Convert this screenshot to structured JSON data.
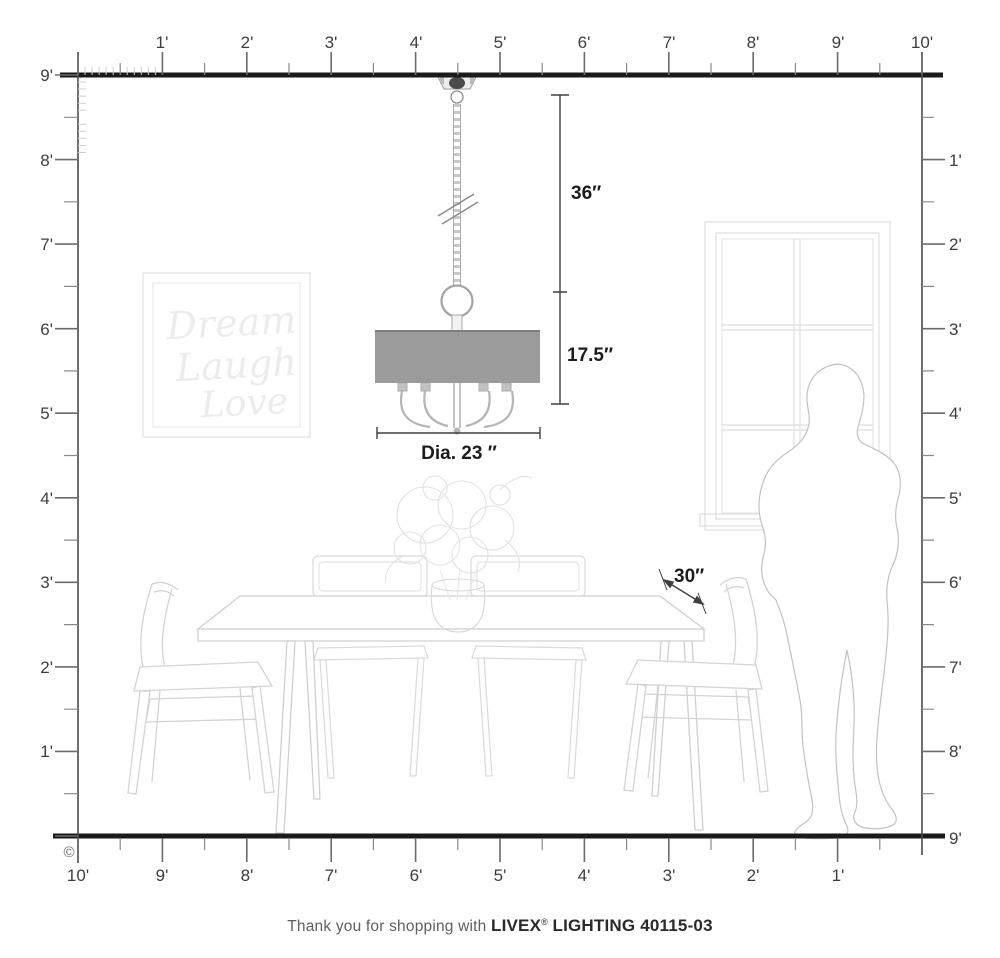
{
  "rulers": {
    "top": {
      "labels": [
        "1'",
        "2'",
        "3'",
        "4'",
        "5'",
        "6'",
        "7'",
        "8'",
        "9'",
        "10'"
      ]
    },
    "left": {
      "labels": [
        "9'",
        "8'",
        "7'",
        "6'",
        "5'",
        "4'",
        "3'",
        "2'",
        "1'"
      ]
    },
    "right": {
      "labels": [
        "1'",
        "2'",
        "3'",
        "4'",
        "5'",
        "6'",
        "7'",
        "8'",
        "9'"
      ]
    },
    "bottom": {
      "labels": [
        "10'",
        "9'",
        "8'",
        "7'",
        "6'",
        "5'",
        "4'",
        "3'",
        "2'",
        "1'"
      ]
    }
  },
  "dimensions": {
    "chain_drop": "36″",
    "fixture_height": "17.5″",
    "diameter": "Dia. 23 ″",
    "table_width": "30″"
  },
  "wall_art": {
    "lines": [
      "Dream",
      "Laugh",
      "Love"
    ]
  },
  "footer": {
    "prefix": "Thank you for shopping with",
    "brand": "LIVEX",
    "registered": "®",
    "model": "LIGHTING 40115-03"
  },
  "copyright": {
    "symbol": "©"
  },
  "colors": {
    "structure_line": "#1a1a1a",
    "tick_major": "#6b6b6b",
    "tick_minor": "#8a8a8a",
    "tick_inch": "#cfcfcf",
    "furniture_line": "#d4d4d4",
    "person_line": "#c2c2c2",
    "shade_fill": "#9b9b9b",
    "metal_line": "#b0b0b0",
    "dimension_line": "#3f3f3f"
  }
}
